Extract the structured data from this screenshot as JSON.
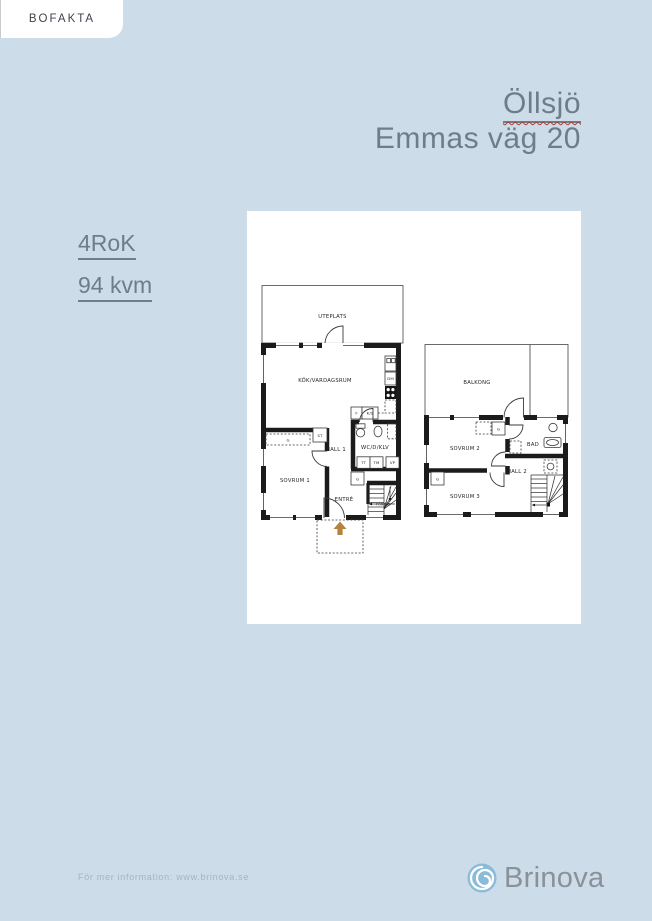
{
  "theme": {
    "bg": "#ccdce8",
    "muted": "#6f7d88",
    "squiggle": "#b03a2e",
    "tab_text": "#3d444b",
    "plan_ink": "#1f1f1f",
    "arrow": "#b5823f",
    "footer_text": "#a7b4bf",
    "brand_text": "#8a9199",
    "logo_blue": "#8abbd8",
    "logo_swirl": "#ffffff"
  },
  "tab": {
    "label": "BOFAKTA"
  },
  "header": {
    "area": "Öllsjö",
    "address": "Emmas väg 20"
  },
  "facts": {
    "rooms": "4RoK",
    "size": "94 kvm"
  },
  "floorplan": {
    "labels": {
      "uteplats": "UTEPLATS",
      "kok": "KÖK/VARDAGSRUM",
      "f": "F",
      "ks": "K/S",
      "dm": "DM",
      "wc": "WC/D/KLV",
      "tt": "TT",
      "tm": "TM",
      "vp": "VP",
      "st": "ST",
      "g": "G",
      "hall1": "HALL 1",
      "sovrum1": "SOVRUM 1",
      "entre": "ENTRÉ",
      "forrad": "FÖRRÅD",
      "balkong": "BALKONG",
      "sovrum2": "SOVRUM 2",
      "bad": "BAD",
      "hall2": "HALL 2",
      "sovrum3": "SOVRUM 3"
    }
  },
  "footer": {
    "info": "För mer information: www.brinova.se",
    "brand": "Brinova"
  }
}
